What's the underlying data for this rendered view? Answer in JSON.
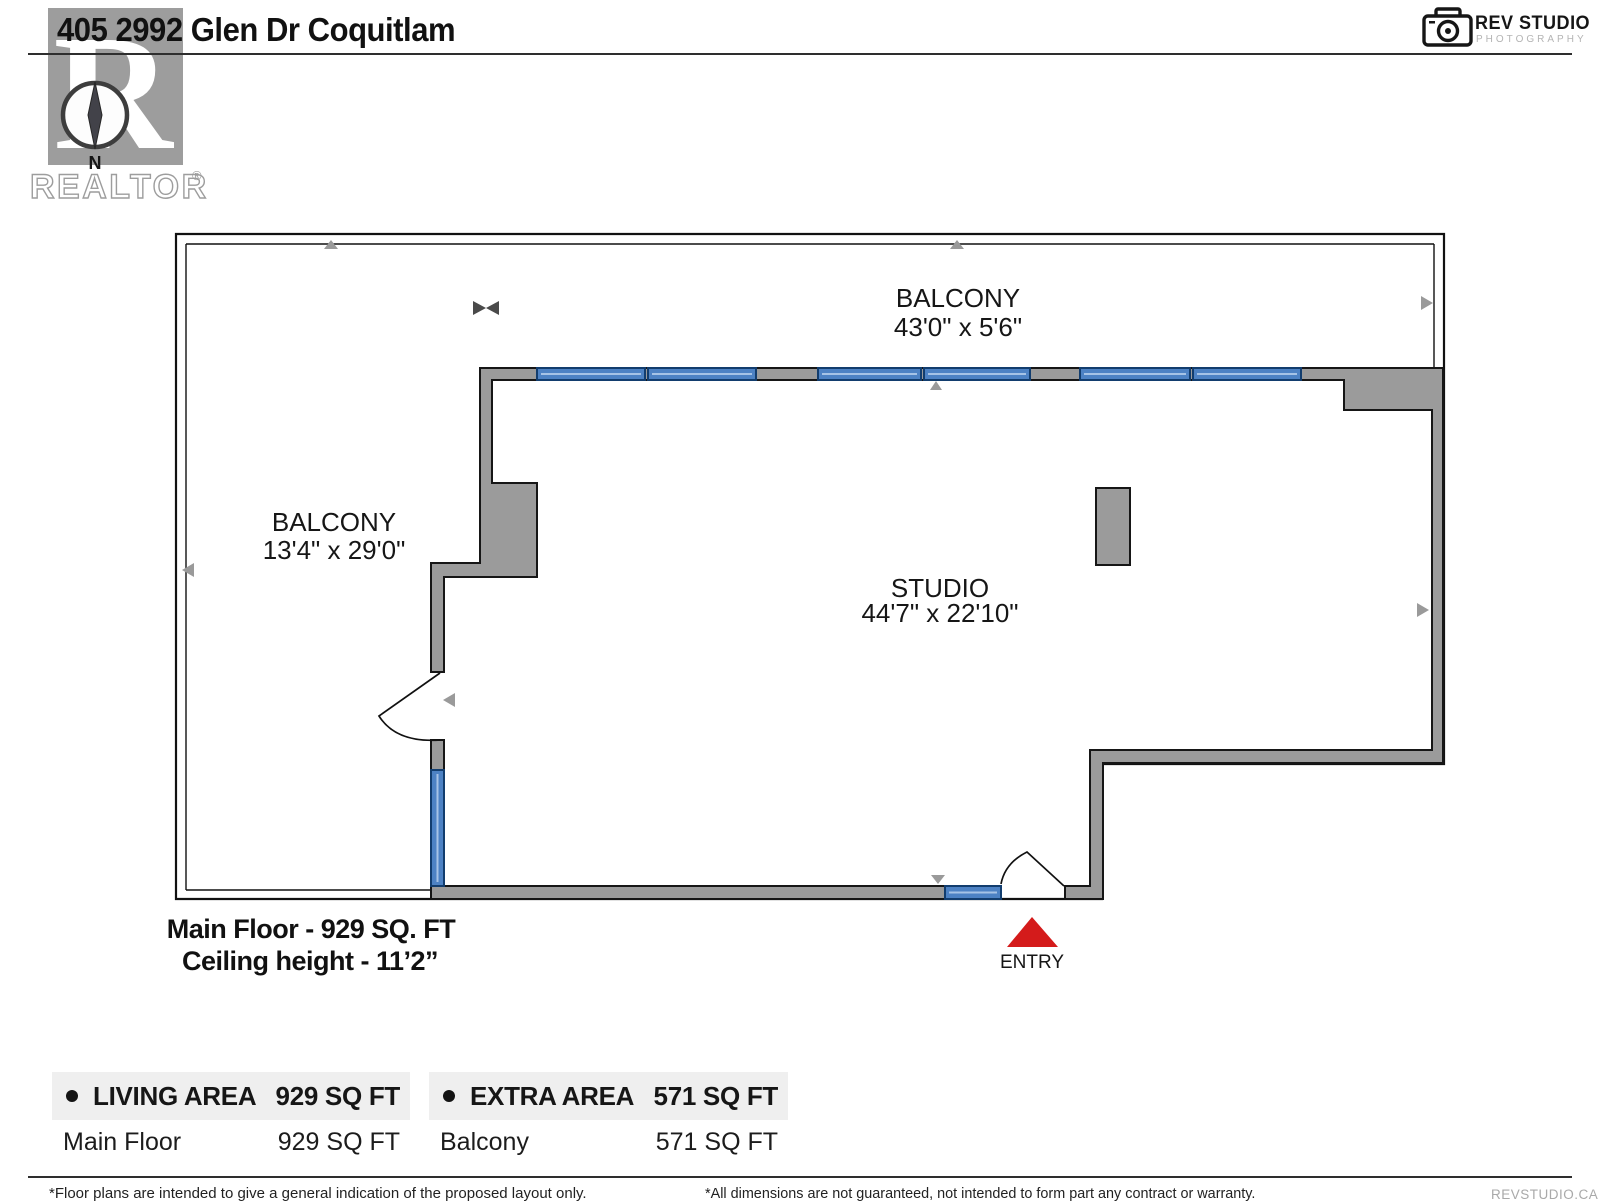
{
  "header": {
    "title": "405 2992 Glen Dr Coquitlam",
    "studio_logo": {
      "name": "REV STUDIO",
      "sub": "PHOTOGRAPHY"
    },
    "watermark": {
      "brand": "REALTOR",
      "registered": "®",
      "letter": "R",
      "compass_north": "N"
    }
  },
  "plan": {
    "rooms": [
      {
        "name": "BALCONY",
        "dims": "43'0\" x 5'6\""
      },
      {
        "name": "BALCONY",
        "dims": "13'4\" x 29'0\""
      },
      {
        "name": "STUDIO",
        "dims": "44'7\" x 22'10\""
      }
    ],
    "entry_label": "ENTRY",
    "floor_note": "Main Floor - 929 SQ. FT",
    "ceiling_note": "Ceiling height - 11’2”",
    "colors": {
      "wall": "#9b9b9b",
      "window": "#4d82c4",
      "entry": "#d41b1b"
    }
  },
  "tables": [
    {
      "header": {
        "label": "LIVING AREA",
        "value": "929 SQ FT"
      },
      "rows": [
        {
          "label": "Main Floor",
          "value": "929 SQ FT"
        }
      ]
    },
    {
      "header": {
        "label": "EXTRA AREA",
        "value": "571 SQ FT"
      },
      "rows": [
        {
          "label": "Balcony",
          "value": "571 SQ FT"
        }
      ]
    }
  ],
  "footer": {
    "left_note": "*Floor plans are intended to give a general indication of the proposed layout only.",
    "right_note": "*All dimensions are not guaranteed, not intended to form part any contract or warranty.",
    "brand": "REVSTUDIO.CA"
  }
}
